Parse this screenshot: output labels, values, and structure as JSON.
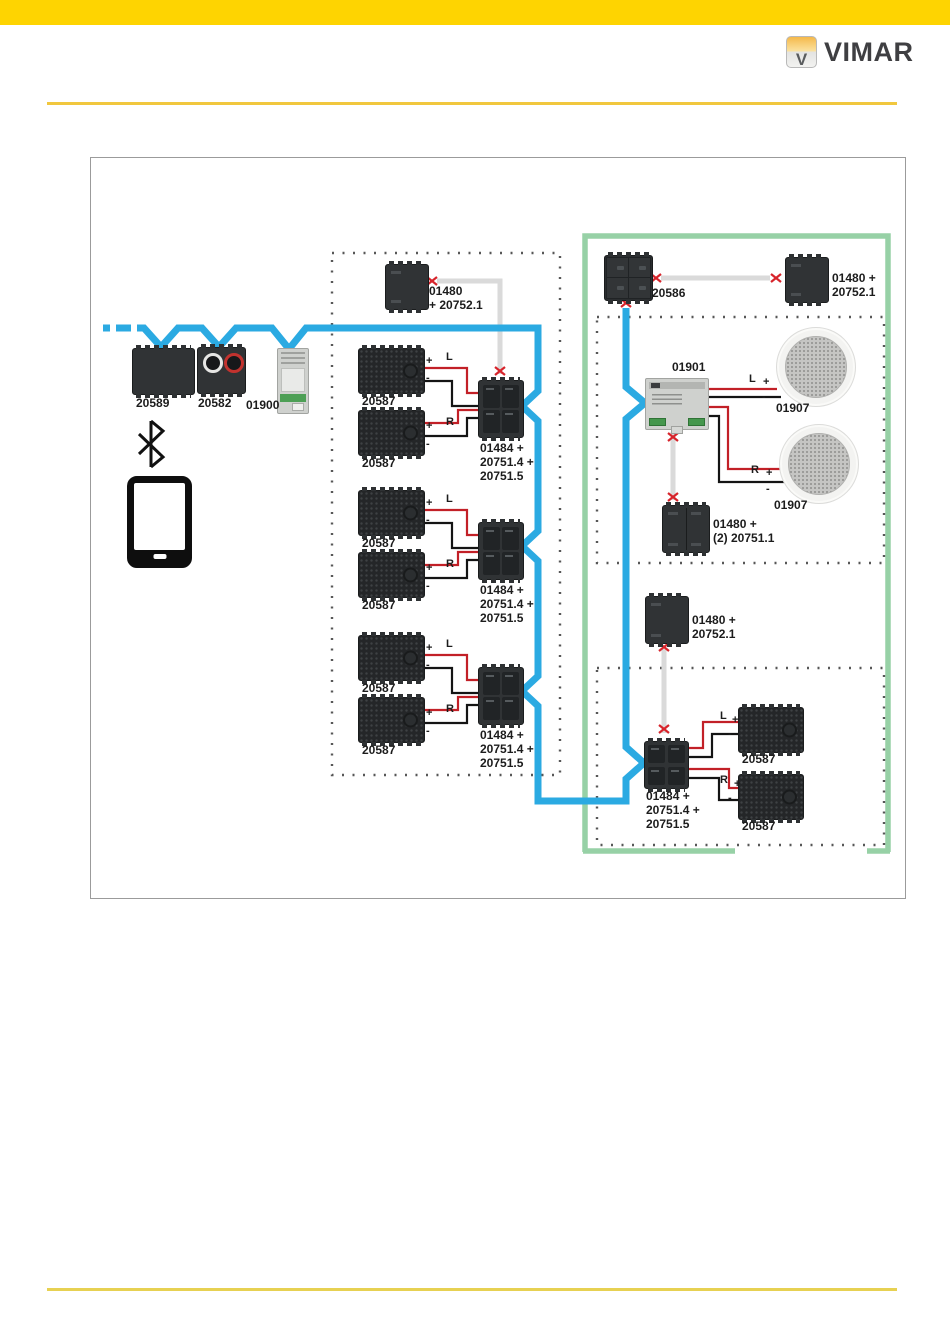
{
  "brand": {
    "name": "VIMAR",
    "badge_letter": "V"
  },
  "colors": {
    "top_bar": "#fed401",
    "rule_gold": "#f1c73e",
    "bus_blue": "#2baae2",
    "zone_green": "#97d1a6",
    "wire_red": "#c22027",
    "wire_black": "#141414",
    "cable_gray": "#dadada",
    "twist_red": "#d7242b"
  },
  "wire_labels": {
    "plus": "+",
    "minus": "-",
    "left": "L",
    "right": "R"
  },
  "parts": {
    "bt_receiver": "20589",
    "rca_socket": "20582",
    "sound_system": "01900",
    "speaker": "20587",
    "keypad": "20586",
    "din_amplifier": "01901",
    "ceiling_speaker": "01907",
    "amp_l1": "01484 +",
    "amp_l2": "20751.4 +",
    "amp_l3": "20751.5",
    "ctrl_l1": "01480",
    "ctrl_l2": "+ 20752.1",
    "ctrl2_l1": "01480 +",
    "ctrl2_l2": "20752.1",
    "ctrl_double_l1": "01480 +",
    "ctrl_double_l2": "(2) 20751.1"
  }
}
